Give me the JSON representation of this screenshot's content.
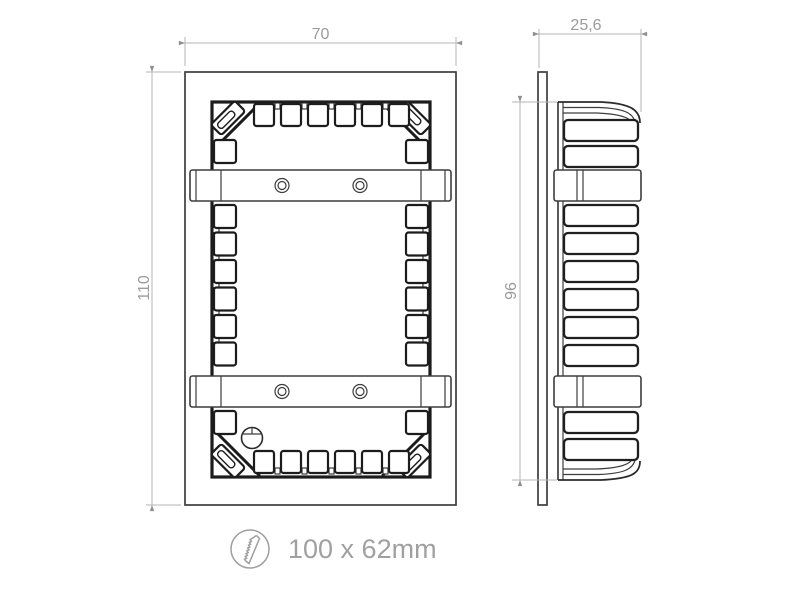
{
  "drawing": {
    "front_view": {
      "width_label": "70",
      "height_label": "110"
    },
    "side_view": {
      "depth_label": "25,6",
      "body_height_label": "96"
    },
    "cutout": {
      "size_label": "100 x 62mm",
      "icon": "saw-blade-icon"
    },
    "colors": {
      "object_line": "#3d3d3d",
      "object_line_thick": "#1c1c1c",
      "dimension_line": "#b5b5b5",
      "dimension_arrow": "#909090",
      "dimension_text": "#9b9b9b",
      "cutout_text": "#a0a0a0",
      "background": "#ffffff"
    }
  }
}
